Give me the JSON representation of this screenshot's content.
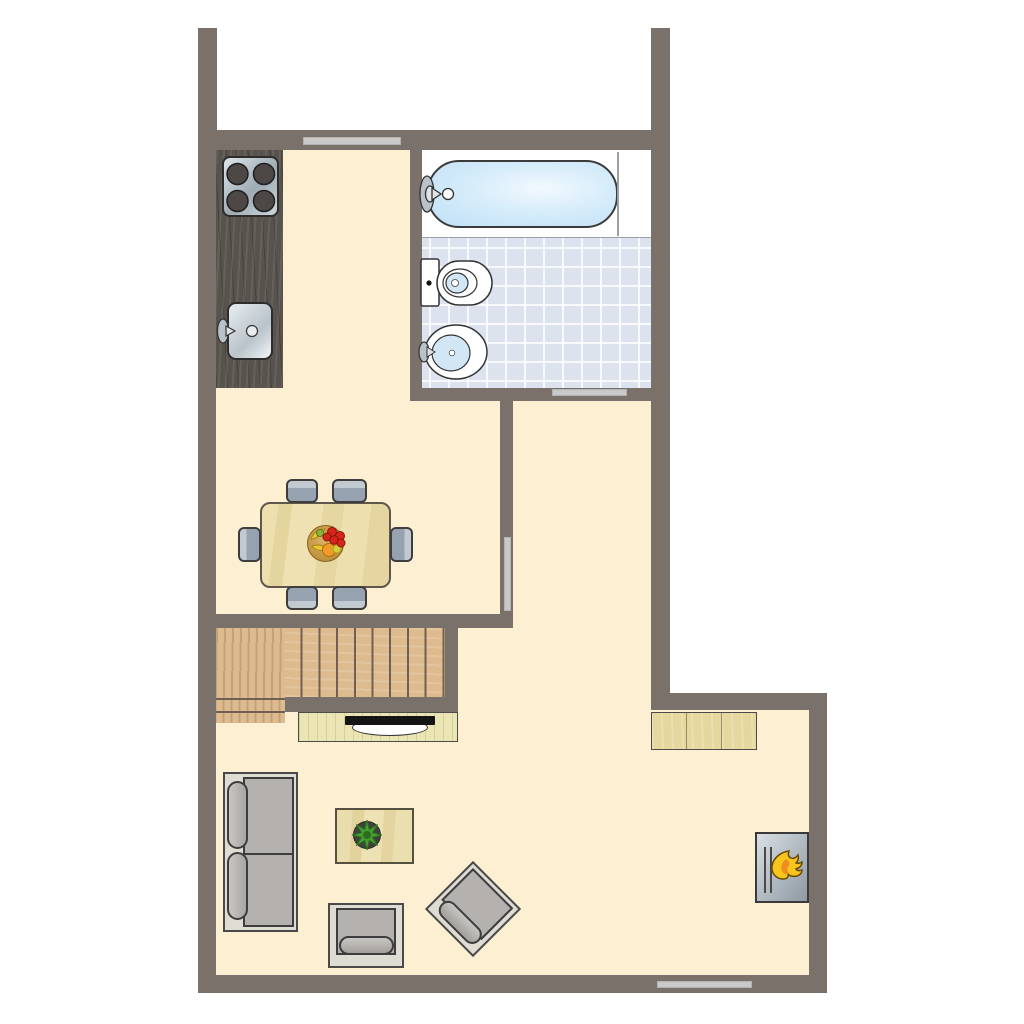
{
  "colors": {
    "wall": "#7a716a",
    "floor": "#fdf0d2",
    "opening": "#c9c9c9",
    "tile": "#dce3ee",
    "tub_blue": "#bfe0f6",
    "fixture_white": "#ffffff",
    "fixture_blue": "#d2e7f6",
    "metal": "#b9c2c8",
    "metal_light": "#dfe3e6",
    "burner": "#4d4845",
    "drain": "#e8ecef",
    "flame_yellow": "#f7c51d",
    "flame_orange": "#ef8d1f",
    "plant_green": "#44a131",
    "plant_dark": "#2d6e1e",
    "plant_pot": "#40433c",
    "fruit_red": "#d6261a",
    "fruit_orange": "#f19a25",
    "fruit_banana": "#ecc62c",
    "fruit_lime": "#d9cf3a",
    "fruit_green": "#8cb43c",
    "toilet_dot": "#111111"
  },
  "plan": {
    "floor_main": {
      "style": "left:216px;top:150px;width:435px;height:825px;background:#fdf0d2"
    },
    "floor_wing": {
      "style": "left:651px;top:710px;width:158px;height:265px;background:#fdf0d2"
    },
    "tub_deck": {
      "style": "left:422px;top:150px;width:229px;height:87px;background:#ffffff"
    },
    "tile_floor": {
      "style": "left:422px;top:237px;width:229px;height:151px;border-top:1px solid #9aa0a6;background-color:#dce3ee;background-image:linear-gradient(rgba(255,255,255,.8) 2px,transparent 2px),linear-gradient(90deg,rgba(255,255,255,.8) 2px,transparent 2px);background-size:19px 19px;background-position:7px 9px"
    },
    "tub": {
      "style": "left:427px;top:160px;width:191px;height:68px;border-radius:32px;border:2px solid #3b3b3b;background:radial-gradient(ellipse at 60% 42%,#f2f9fe 0%,#d6ecfa 45%,#bfe0f6 100%)"
    },
    "tub_divider": {
      "style": "left:617px;top:152px;width:2px;height:84px;background:#9aa0a6"
    },
    "wall_stub_left": {
      "style": "left:198px;top:28px;width:19px;height:102px;background:#7a716a"
    },
    "wall_stub_right": {
      "style": "left:651px;top:28px;width:19px;height:102px;background:#7a716a"
    },
    "wall_top": {
      "style": "left:198px;top:130px;width:472px;height:20px;background:#7a716a"
    },
    "wall_left": {
      "style": "left:198px;top:150px;width:18px;height:843px;background:#7a716a"
    },
    "wall_bottom": {
      "style": "left:198px;top:975px;width:629px;height:18px;background:#7a716a"
    },
    "wall_right_upper": {
      "style": "left:651px;top:150px;width:19px;height:560px;background:#7a716a"
    },
    "wall_step": {
      "style": "left:651px;top:693px;width:176px;height:17px;background:#7a716a"
    },
    "wall_right_lower": {
      "style": "left:809px;top:693px;width:18px;height:300px;background:#7a716a"
    },
    "wall_bath_left": {
      "style": "left:410px;top:150px;width:12px;height:250px;background:#7a716a"
    },
    "wall_bath_bottom": {
      "style": "left:410px;top:388px;width:241px;height:13px;background:#7a716a"
    },
    "wall_hall": {
      "style": "left:500px;top:388px;width:13px;height:240px;background:#7a716a"
    },
    "wall_dining_bottom": {
      "style": "left:198px;top:614px;width:315px;height:14px;background:#7a716a"
    },
    "wall_stair_right": {
      "style": "left:445px;top:628px;width:13px;height:83px;background:#7a716a"
    },
    "wall_understair": {
      "style": "left:285px;top:697px;width:173px;height:15px;background:#7a716a"
    },
    "window_top": {
      "style": "left:303px;top:137px;width:98px;height:8px;background:#c9c9c9;border:1px solid #b2b2b2"
    },
    "bath_door": {
      "style": "left:552px;top:389px;width:75px;height:7px;background:#c9c9c9;border:1px solid #b2b2b2"
    },
    "hall_door": {
      "style": "left:504px;top:537px;width:7px;height:74px;background:#c9c9c9;border:1px solid #b2b2b2"
    },
    "window_bottom": {
      "style": "left:657px;top:981px;width:95px;height:7px;background:#c9c9c9;border:1px solid #b2b2b2"
    },
    "counter": {
      "style": "left:216px;top:150px;width:67px;height:238px;background-color:#59534e;background-image:repeating-linear-gradient(93deg,rgba(255,255,255,.08) 0 2px,transparent 2px 7px),repeating-linear-gradient(87deg,rgba(0,0,0,.2) 0 1px,transparent 1px 11px)"
    },
    "stove": {
      "style": "left:222px;top:156px;width:57px;height:61px;border-radius:8px;border:2px solid #2d2d2d;background:linear-gradient(135deg,#dfe6ea 0%,#9fabb4 55%,#cdd6db 100%)"
    },
    "kitchen_sink": {
      "style": "left:227px;top:302px;width:46px;height:58px;border-radius:9px;border:2px solid #2d2d2d;background:linear-gradient(135deg,#e8edf0 0%,#b9c3ca 60%,#f2f5f7 100%)"
    },
    "table": {
      "style": "left:260px;top:502px;width:131px;height:86px;border-radius:10px;border:2px solid #5f574b;background-color:#ecdcaa;background-image:linear-gradient(97deg,#eedfae 0 12%,#e4d49e 12% 22%,#efe1b2 22% 45%,#e6d6a2 45% 60%,#eedfae 60% 80%,#e5d5a0 80%)"
    },
    "chair_top_1": {
      "style": "left:286px;top:479px;width:32px;height:24px;border:2px solid #3d3d3d;border-radius:6px;background:linear-gradient(180deg,#c2c9d0 0 34%,#96a2af 34%)"
    },
    "chair_top_2": {
      "style": "left:332px;top:479px;width:35px;height:24px;border:2px solid #3d3d3d;border-radius:6px;background:linear-gradient(180deg,#c2c9d0 0 34%,#96a2af 34%)"
    },
    "chair_bottom_1": {
      "style": "left:286px;top:586px;width:32px;height:24px;border:2px solid #3d3d3d;border-radius:6px;background:linear-gradient(0deg,#c2c9d0 0 34%,#96a2af 34%)"
    },
    "chair_bottom_2": {
      "style": "left:332px;top:586px;width:35px;height:24px;border:2px solid #3d3d3d;border-radius:6px;background:linear-gradient(0deg,#c2c9d0 0 34%,#96a2af 34%)"
    },
    "chair_left": {
      "style": "left:238px;top:527px;width:23px;height:35px;border:2px solid #3d3d3d;border-radius:6px;background:linear-gradient(90deg,#c2c9d0 0 34%,#96a2af 34%)"
    },
    "chair_right": {
      "style": "left:390px;top:527px;width:23px;height:35px;border:2px solid #3d3d3d;border-radius:6px;background:linear-gradient(270deg,#c2c9d0 0 34%,#96a2af 34%)"
    },
    "fruit_bowl": {
      "style": "left:307px;top:525px;width:37px;height:37px;border-radius:50%;border:1px solid #86621f;background:radial-gradient(circle at 45% 40%,#dcb265 0%,#c0913d 70%,#9e7227 100%)"
    },
    "stair_treads": {
      "style": "left:285px;top:628px;width:160px;height:69px;background-color:#debb8e;background-image:repeating-linear-gradient(90deg,transparent 0 15.7px,#6f6053 15.7px 17.7px),repeating-linear-gradient(2deg,rgba(255,255,255,.14) 0 2px,transparent 2px 9px)"
    },
    "stair_landing": {
      "style": "left:216px;top:628px;width:69px;height:95px;background-color:#debb8e;background-image:linear-gradient(#6f6053,#6f6053),linear-gradient(#6f6053,#6f6053),repeating-linear-gradient(91deg,rgba(120,90,60,.25) 0 2px,transparent 2px 8px);background-size:100% 2px,100% 2px,100% 100%;background-position:0 70px,0 83px,0 0;background-repeat:no-repeat,no-repeat,repeat"
    },
    "tv_cabinet": {
      "style": "left:298px;top:712px;width:160px;height:30px;border:1px solid #4a4a4a;background-color:#eae5b2;background-image:repeating-linear-gradient(90deg,rgba(120,110,60,.18) 0 1px,transparent 1px 9px)"
    },
    "tv_arc": {
      "style": "left:352px;top:719px;width:76px;height:17px;border-radius:50%;border:1px solid #333333;background:#ffffff"
    },
    "tv_bar": {
      "style": "left:345px;top:716px;width:90px;height:9px;background:#141414;border-radius:1px"
    },
    "sideboard": {
      "style": "left:651px;top:712px;width:106px;height:38px;border:1px solid #4a4a4a;background-color:#e6d79e;background-image:linear-gradient(90deg,transparent 0 34px,rgba(90,75,45,.55) 34px 35px,transparent 35px 69px,rgba(90,75,45,.55) 69px 70px,transparent 70px),repeating-linear-gradient(88deg,rgba(255,255,255,.2) 0 2px,transparent 2px 10px)"
    },
    "sofa_frame": {
      "style": "left:223px;top:772px;width:75px;height:160px;border:2px solid #4a4a4a;background:#dedcd3"
    },
    "sofa_seat": {
      "style": "left:243px;top:777px;width:51px;height:150px;border:2px solid #3d3d3d;background-color:#b4b1ae;background-image:linear-gradient(#3d3d3d,#3d3d3d);background-size:100% 2px;background-position:0 74px;background-repeat:no-repeat"
    },
    "sofa_back_1": {
      "style": "left:227px;top:781px;width:21px;height:68px;border-radius:11px;border:2px solid #3d3d3d;background:linear-gradient(90deg,#c8c6c2,#a8a5a2)"
    },
    "sofa_back_2": {
      "style": "left:227px;top:852px;width:21px;height:68px;border-radius:11px;border:2px solid #3d3d3d;background:linear-gradient(90deg,#c8c6c2,#a8a5a2)"
    },
    "coffee_table": {
      "style": "left:335px;top:808px;width:79px;height:56px;border:2px solid #55503f;background-color:#e9dcab;background-image:linear-gradient(94deg,#eaddad 0 20%,#e2d29c 20% 35%,#eee2b5 35% 60%,#e4d4a0 60% 75%,#ebdfb0 75%)"
    },
    "armchair_frame": {
      "style": "left:328px;top:903px;width:76px;height:65px;border:2px solid #4a4a4a;background:#dedcd3"
    },
    "armchair_cushion": {
      "style": "left:336px;top:908px;width:60px;height:47px;border:2px solid #3d3d3d;background:#b4b1ae"
    },
    "armchair_roll": {
      "style": "left:339px;top:936px;width:55px;height:19px;border-radius:10px;border:2px solid #3d3d3d;background:linear-gradient(180deg,#c8c6c2,#a39f9c)"
    },
    "armchair2": {
      "style": "left:439px;top:875px;width:68px;height:68px;transform:rotate(45deg);border:2px solid #4a4a4a;background:#dedcd3"
    },
    "armchair2_cushion": {
      "style": "left:3px;top:3px;width:57px;height:45px;border:2px solid #3d3d3d;background:#b4b1ae"
    },
    "armchair2_roll": {
      "style": "left:6px;top:41px;width:53px;height:19px;border-radius:10px;border:2px solid #3d3d3d;background:linear-gradient(180deg,#c8c6c2,#a39f9c)"
    },
    "fireplace": {
      "style": "left:755px;top:832px;width:54px;height:71px;border:2px solid #3a3a3a;background-color:#b9c2c9;background-image:linear-gradient(#4a4a4a,#4a4a4a),linear-gradient(#4a4a4a,#4a4a4a),linear-gradient(125deg,#d9dfe4 0%,#8e99a2 100%);background-size:2px 46px,2px 46px,100% 100%;background-position:7px 13px,13px 13px,0 0;background-repeat:no-repeat,no-repeat,no-repeat"
    }
  }
}
